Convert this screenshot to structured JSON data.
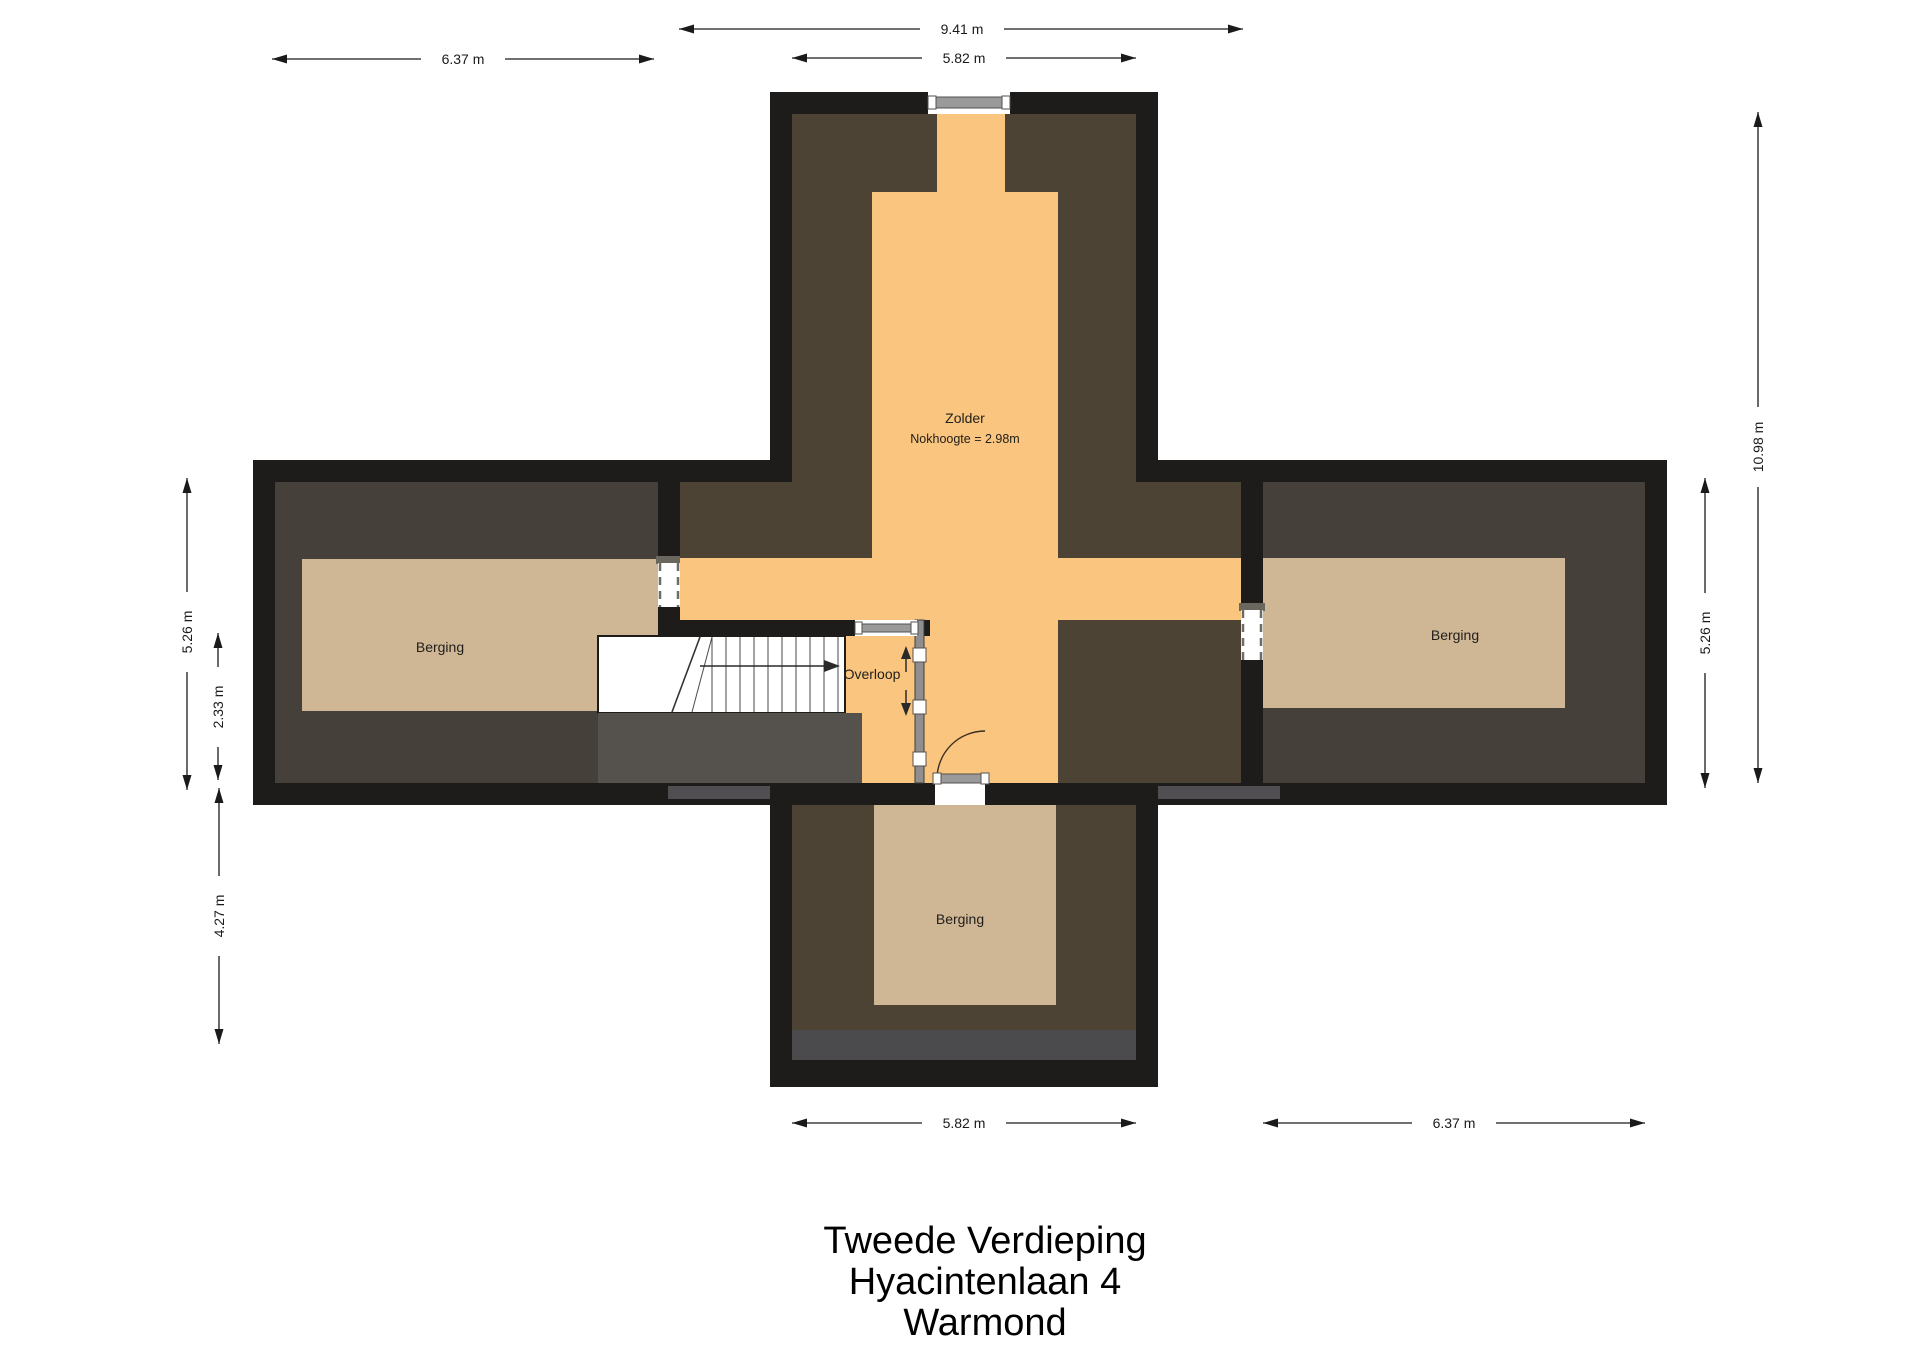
{
  "title": {
    "lines": [
      "Tweede Verdieping",
      "Hyacintenlaan 4",
      "Warmond"
    ]
  },
  "rooms": {
    "zolder": {
      "label": "Zolder",
      "sublabel": "Nokhoogte = 2.98m"
    },
    "overloop": {
      "label": "Overloop"
    },
    "berging_left": {
      "label": "Berging"
    },
    "berging_right": {
      "label": "Berging"
    },
    "berging_bottom": {
      "label": "Berging"
    }
  },
  "dimensions": {
    "core_outer_width": "9.41 m",
    "top_section_width": "5.82 m",
    "left_wing_width": "6.37 m",
    "left_wing_height": "5.26 m",
    "stair_zone_height": "2.33 m",
    "bottom_section_height": "4.27 m",
    "total_height": "10.98 m",
    "right_wing_height": "5.26 m",
    "bottom_section_width": "5.82 m",
    "right_wing_width": "6.37 m"
  },
  "colors": {
    "wall": "#1d1c1a",
    "wing_floor": "#454039",
    "core_floor": "#4c4334",
    "attic_floor": "#fac57e",
    "storage_floor": "#cfb695",
    "shadow_gray": "#55514d",
    "strip_gray": "#4b4a4c",
    "strip_gray_light": "#504e50",
    "window_gray": "#9a9a9a",
    "partition_gray": "#8f8f8f",
    "background": "#ffffff"
  }
}
